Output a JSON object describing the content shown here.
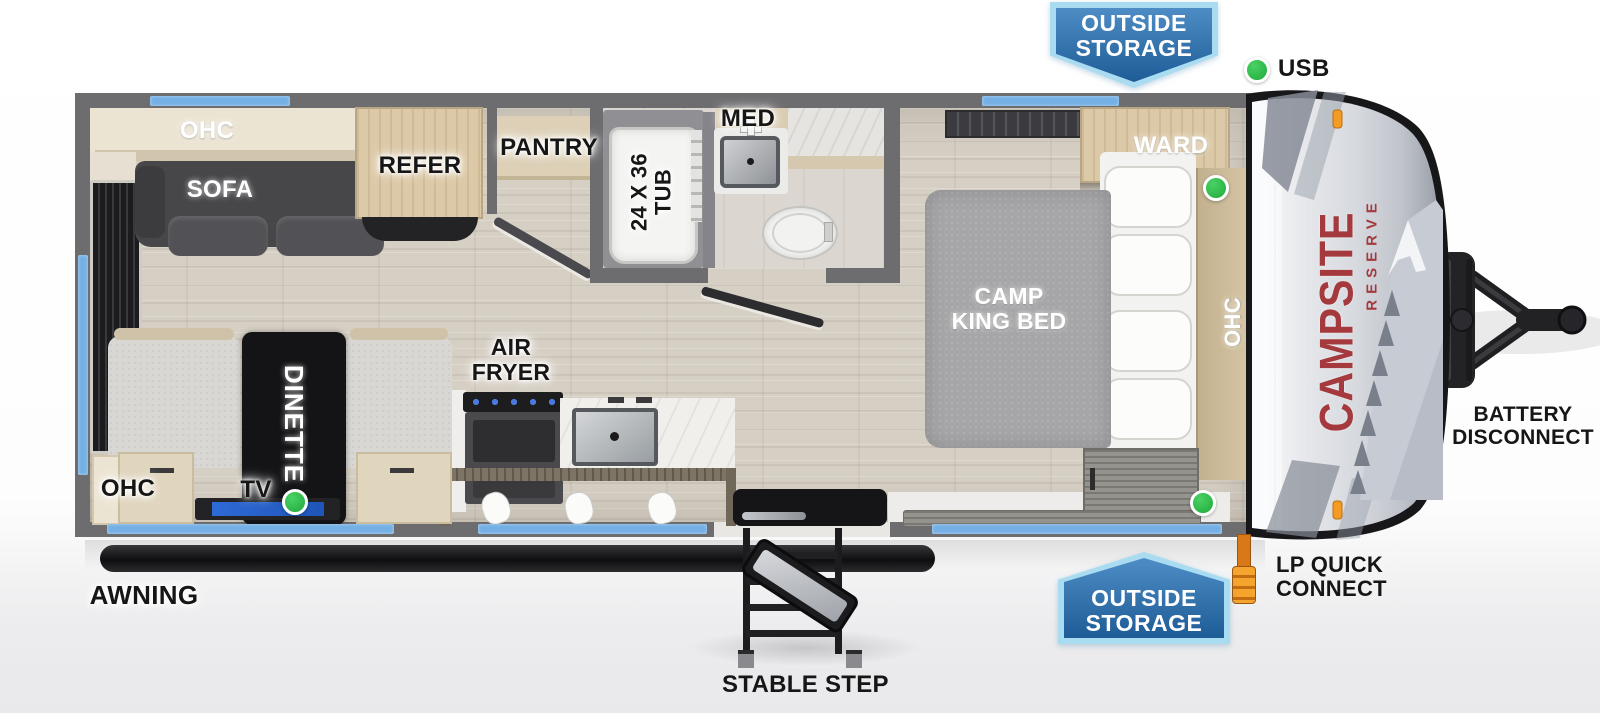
{
  "brand": {
    "line1": "CAMPSITE",
    "line2": "RESERVE"
  },
  "rooms": {
    "living": {
      "ohc_overhead": "OHC",
      "sofa": "SOFA",
      "refer": "REFER",
      "pantry": "PANTRY",
      "dinette": "DINETTE",
      "tv": "TV",
      "ohc_corner": "OHC"
    },
    "kitchen": {
      "air_fryer_line1": "AIR",
      "air_fryer_line2": "FRYER"
    },
    "bath": {
      "med": "MED",
      "tub_line1": "24 X 36",
      "tub_line2": "TUB"
    },
    "bedroom": {
      "ward": "WARD",
      "bed_line1": "CAMP",
      "bed_line2": "KING BED",
      "ohc_side": "OHC"
    }
  },
  "callouts": {
    "outside_storage_line1": "OUTSIDE",
    "outside_storage_line2": "STORAGE",
    "usb": "USB",
    "awning": "AWNING",
    "stable_step": "STABLE STEP",
    "lp_line1": "LP QUICK",
    "lp_line2": "CONNECT",
    "battery_line1": "BATTERY",
    "battery_line2": "DISCONNECT"
  },
  "colors": {
    "window_blue": "#74b0e4",
    "wall_gray": "#6d6d6f",
    "badge_border": "#a9dcf0",
    "badge_fill_top": "#4d8cc4",
    "badge_fill_bottom": "#1e5c97",
    "brand_red": "#a43a3e",
    "indicator_green": "#2db847",
    "clearance_orange": "#f39b22",
    "lp_orange": "#d87818"
  }
}
